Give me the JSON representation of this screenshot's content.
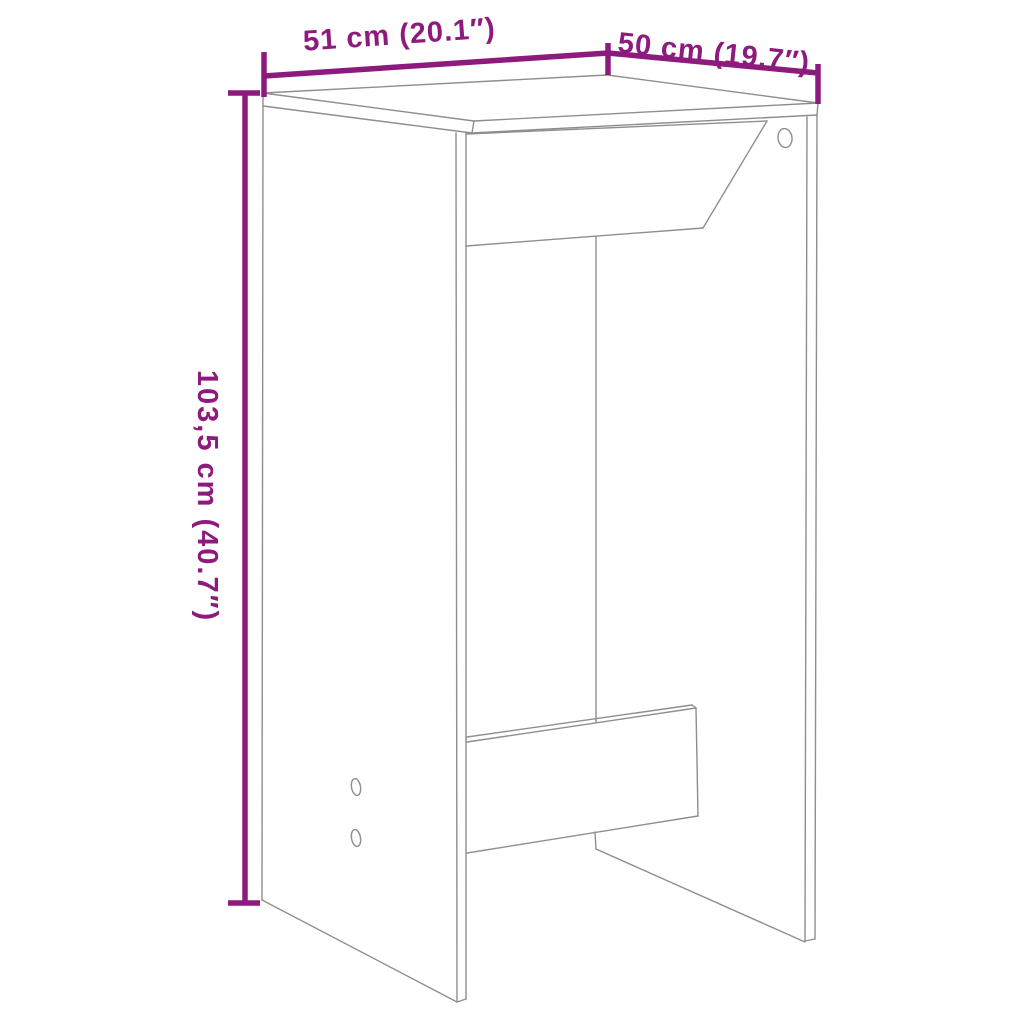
{
  "diagram": {
    "description": "bar-table-dimension-drawing",
    "dimensions": {
      "width_label": "51 cm (20.1″)",
      "depth_label": "50 cm (19.7″)",
      "height_label": "103,5 cm (40.7″)"
    }
  },
  "colors": {
    "dimension": "#8d1a7d",
    "drawing": "#8e8e8e",
    "background": "#ffffff"
  }
}
